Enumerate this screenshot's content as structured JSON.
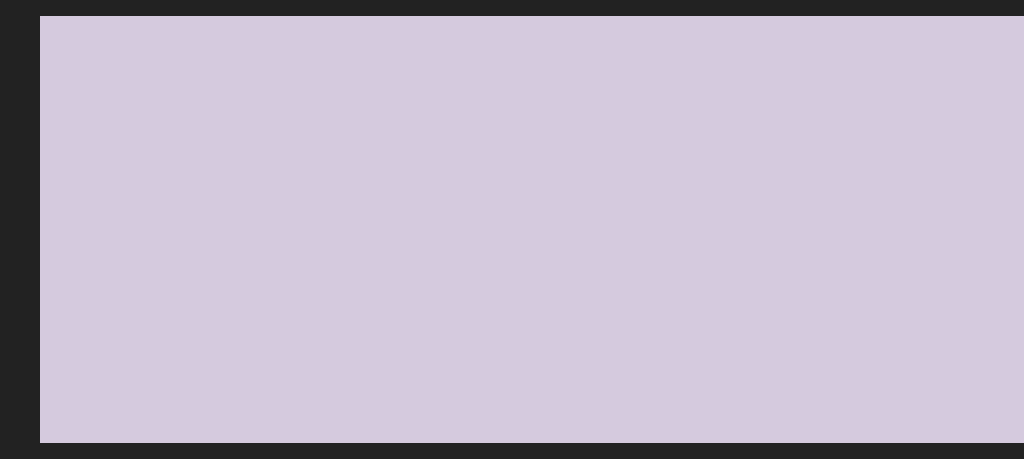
{
  "meta": {
    "description": "Aerial 3D architectural rendering of a gated villa community: two staggered rows of ten white duplex villas with copper hip roofs and dormers, each plot with a turquoise private pool, timber sun deck, loungers, parasols, tan feature walls and palm trees; a tree-lined road runs behind the estate, a curving road bordered by dense woodland runs along the right, stone retaining walls and large trees frame the lower-left foreground",
    "width": 1024,
    "height": 427
  },
  "palette": {
    "canvas": "#d5cade",
    "road": "#cdc2d9",
    "roadLight": "#ded4e0",
    "roadDark": "#b2a2bb",
    "roadShadow": "#6b5a86",
    "curb": "#f1ecf6",
    "centerline": "#fafdff",
    "paleGround": "#d8d0c6",
    "distantTan": "#c4b29e",
    "lawn": "#63a433",
    "lawnLight": "#7fbd45",
    "lawnShade": "#4f8a2c",
    "hedge": "#3f6134",
    "backWall": "#75777f",
    "wallLight": "#a6a3b2",
    "wallDark": "#565869",
    "wallCap": "#cfccd6",
    "stoneDark": "#544f4a",
    "stoneCap": "#9b97a1",
    "stoneTick": "#d3cfd8",
    "shadowPath": "#5a5477",
    "frontFace": "#efe8da",
    "sideFace": "#faf6ec",
    "slab": "#f8f4ea",
    "underEave": "#cdbfae",
    "winDark": "#2f3b41",
    "winTeal": "#5b8a92",
    "wood": "#7b4f2c",
    "roofBase": "#b97c4a",
    "roofStripe": "#935c33",
    "roofRidge": "#ecc196",
    "roofHipEdge": "#e5b98b",
    "fascia": "#f6f1e8",
    "roofShrub": "#4c7c3a",
    "pool": "#2cb3cd",
    "poolDeep": "#1b98b5",
    "poolEdge": "#ece4d2",
    "deck": "#cf9f63",
    "featureWall": "#c9a575",
    "featureWallTop": "#e0c292",
    "slat": "#7e522d",
    "pergola": "#2b3750",
    "parasol": "#f6f4ef",
    "palmTrunk": "#7d5f3e",
    "palmFrond": "#3f7a37",
    "palmFrondLight": "#66a34c",
    "treeBase": "#6b9150",
    "treeHi": "#8fb36c",
    "treeDark": "#49693a",
    "forestFloor": "#4e6a42",
    "forestBase": "#87a06f",
    "forestHi": "#a9bd8c",
    "forestDark": "#5a784c",
    "forestDeep": "#3d5837",
    "bigTreeBase": "#567d40",
    "bigTreeHi": "#7ca75c",
    "bigTreeDark": "#35522b",
    "bigTreeTop": "#95bd74",
    "redRoof": "#a34e37",
    "redRoofDark": "#8f4531",
    "buildingShadow": "#2e4a22"
  },
  "villaGeometry": {
    "basisU": [
      1,
      -0.42
    ],
    "basisV": [
      0.62,
      0.34
    ],
    "W": 150,
    "D": 58,
    "H": 52,
    "rise": 36,
    "overhang": 9,
    "ridgeInset": 40,
    "pool": {
      "back": {
        "a0": 82,
        "a1": 142,
        "b0": 58,
        "b1": 100
      },
      "front": {
        "a0": 82,
        "a1": 138,
        "b0": 116,
        "b1": 168
      }
    }
  },
  "villas": [
    {
      "id": "back-5",
      "x": 512,
      "y": 72,
      "s": 0.57,
      "row": "back",
      "dormers": 2,
      "plotDepth": 150,
      "plotW": 224,
      "palms": [
        [
          192,
          40
        ],
        [
          30,
          124
        ]
      ]
    },
    {
      "id": "back-4",
      "x": 424,
      "y": 106,
      "s": 0.62,
      "row": "back",
      "dormers": 2,
      "plotDepth": 150,
      "plotW": 224,
      "palms": [
        [
          192,
          42
        ],
        [
          32,
          126
        ]
      ]
    },
    {
      "id": "back-3",
      "x": 330,
      "y": 142,
      "s": 0.68,
      "row": "back",
      "dormers": 2,
      "plotDepth": 152,
      "plotW": 224,
      "palms": [
        [
          194,
          40
        ],
        [
          30,
          128
        ]
      ]
    },
    {
      "id": "back-2",
      "x": 232,
      "y": 180,
      "s": 0.74,
      "row": "back",
      "dormers": 2,
      "plotDepth": 154,
      "plotW": 224,
      "palms": [
        [
          192,
          44
        ],
        [
          34,
          128
        ]
      ]
    },
    {
      "id": "back-1",
      "x": 128,
      "y": 222,
      "s": 0.8,
      "row": "back",
      "dormers": 3,
      "plotDepth": 156,
      "plotW": 224,
      "palms": [
        [
          196,
          42
        ],
        [
          36,
          132
        ]
      ]
    },
    {
      "id": "front-5",
      "x": 720,
      "y": 103,
      "s": 0.7,
      "row": "front",
      "dormers": 2,
      "plotDepth": 135,
      "plotW": 190,
      "palms": [
        [
          184,
          128
        ],
        [
          24,
          150
        ]
      ]
    },
    {
      "id": "front-4",
      "x": 616,
      "y": 155,
      "s": 0.78,
      "row": "front",
      "dormers": 2,
      "plotDepth": 150,
      "plotW": 210,
      "palms": [
        [
          200,
          134
        ],
        [
          26,
          154
        ]
      ]
    },
    {
      "id": "front-3",
      "x": 506,
      "y": 210,
      "s": 0.86,
      "row": "front",
      "dormers": 2,
      "plotDepth": 168,
      "plotW": 224,
      "pergola": true,
      "palms": [
        [
          204,
          142
        ],
        [
          26,
          158
        ]
      ]
    },
    {
      "id": "front-2",
      "x": 390,
      "y": 268,
      "s": 0.94,
      "row": "front",
      "dormers": 2,
      "plotDepth": 182,
      "plotW": 224,
      "pergola": true,
      "palms": [
        [
          206,
          146
        ],
        [
          26,
          162
        ]
      ]
    },
    {
      "id": "front-1",
      "x": 268,
      "y": 330,
      "s": 1.02,
      "row": "front",
      "dormers": 3,
      "plotDepth": 195,
      "plotW": 224,
      "palms": [
        [
          208,
          150
        ],
        [
          30,
          168
        ]
      ]
    }
  ],
  "leftRoad": {
    "poly": [
      [
        0,
        118
      ],
      [
        596,
        0
      ],
      [
        700,
        0
      ],
      [
        0,
        196
      ]
    ],
    "junctionArm": [
      [
        205,
        0
      ],
      [
        262,
        0
      ],
      [
        318,
        48
      ],
      [
        252,
        62
      ]
    ],
    "centerline": {
      "from": [
        0,
        158
      ],
      "to": [
        640,
        -6
      ]
    },
    "curbTop": {
      "from": [
        0,
        118
      ],
      "to": [
        596,
        0
      ]
    },
    "curbBottom": {
      "from": [
        0,
        196
      ],
      "to": [
        700,
        0
      ]
    },
    "hedgeBand": [
      [
        0,
        200
      ],
      [
        708,
        0
      ],
      [
        716,
        0
      ],
      [
        0,
        212
      ]
    ],
    "wallBand": [
      [
        0,
        212
      ],
      [
        716,
        0
      ],
      [
        726,
        0
      ],
      [
        0,
        224
      ]
    ]
  },
  "estate": {
    "outline": [
      [
        0,
        224
      ],
      [
        724,
        0
      ],
      [
        893,
        0
      ],
      [
        820,
        210
      ],
      [
        695,
        380
      ],
      [
        612,
        427
      ],
      [
        190,
        427
      ],
      [
        0,
        310
      ]
    ],
    "mottles": [
      [
        [
          60,
          250
        ],
        [
          240,
          178
        ],
        [
          300,
          200
        ],
        [
          120,
          278
        ]
      ],
      [
        [
          340,
          120
        ],
        [
          520,
          50
        ],
        [
          580,
          70
        ],
        [
          400,
          146
        ]
      ],
      [
        [
          480,
          260
        ],
        [
          640,
          190
        ],
        [
          700,
          214
        ],
        [
          540,
          290
        ]
      ]
    ]
  },
  "rightRoad": {
    "leftEdge": [
      [
        893,
        0
      ],
      [
        865,
        120
      ],
      [
        820,
        210
      ],
      [
        758,
        300
      ],
      [
        690,
        380
      ],
      [
        628,
        427
      ]
    ],
    "rightEdge": [
      [
        925,
        0
      ],
      [
        900,
        115
      ],
      [
        874,
        205
      ],
      [
        832,
        300
      ],
      [
        788,
        380
      ],
      [
        790,
        427
      ]
    ],
    "wallInner": [
      [
        880,
        0
      ],
      [
        852,
        115
      ],
      [
        807,
        205
      ],
      [
        745,
        295
      ],
      [
        677,
        375
      ],
      [
        615,
        427
      ]
    ],
    "wallDarkFrom": 3,
    "shadowSpots": [
      [
        905,
        60
      ],
      [
        885,
        130
      ],
      [
        850,
        200
      ],
      [
        815,
        265
      ],
      [
        778,
        330
      ],
      [
        735,
        390
      ]
    ]
  },
  "terraces": {
    "lawnStrip": [
      [
        150,
        415
      ],
      [
        330,
        334
      ],
      [
        352,
        352
      ],
      [
        165,
        427
      ]
    ],
    "shadowPath": [
      [
        128,
        427
      ],
      [
        208,
        427
      ],
      [
        318,
        335
      ],
      [
        296,
        325
      ],
      [
        150,
        414
      ]
    ],
    "walkway": [
      [
        193,
        420
      ],
      [
        378,
        345
      ],
      [
        382,
        356
      ],
      [
        197,
        431
      ]
    ],
    "wallFace": [
      [
        197,
        431
      ],
      [
        382,
        356
      ],
      [
        384,
        368
      ],
      [
        199,
        443
      ]
    ],
    "tickCount": 15
  },
  "redRoofs": [
    [
      [
        0,
        128
      ],
      [
        26,
        122
      ],
      [
        34,
        150
      ],
      [
        0,
        160
      ]
    ],
    [
      [
        0,
        236
      ],
      [
        30,
        228
      ],
      [
        40,
        256
      ],
      [
        0,
        266
      ]
    ]
  ],
  "paleCorners": {
    "topLeft": [
      [
        0,
        0
      ],
      [
        200,
        0
      ],
      [
        160,
        40
      ],
      [
        0,
        70
      ]
    ],
    "distant": [
      [
        60,
        0
      ],
      [
        230,
        0
      ],
      [
        225,
        16
      ],
      [
        70,
        22
      ]
    ],
    "gap": [
      [
        290,
        0
      ],
      [
        560,
        0
      ],
      [
        540,
        22
      ],
      [
        300,
        26
      ]
    ]
  },
  "treeBands": [
    {
      "name": "roadside-trees-front",
      "from": [
        -25,
        135
      ],
      "to": [
        560,
        -15
      ],
      "count": 14,
      "rMin": 20,
      "rMax": 30,
      "jitter": 8,
      "seed": 11,
      "shadow": true
    },
    {
      "name": "roadside-trees-back",
      "from": [
        -20,
        80
      ],
      "to": [
        300,
        -22
      ],
      "count": 8,
      "rMin": 16,
      "rMax": 24,
      "jitter": 7,
      "seed": 23,
      "shadow": false
    },
    {
      "name": "top-edge-trees",
      "from": [
        556,
        4
      ],
      "to": [
        892,
        -10
      ],
      "count": 10,
      "rMin": 13,
      "rMax": 20,
      "jitter": 6,
      "seed": 31,
      "shadow": false
    }
  ],
  "forest": {
    "poly": [
      [
        915,
        0
      ],
      [
        1024,
        0
      ],
      [
        1024,
        427
      ],
      [
        648,
        427
      ],
      [
        700,
        390
      ],
      [
        770,
        300
      ],
      [
        820,
        220
      ],
      [
        862,
        120
      ],
      [
        880,
        40
      ]
    ],
    "count": 55,
    "rMin": 20,
    "rMax": 40,
    "seed": 7
  },
  "bigTrees": [
    {
      "x": -6,
      "y": 300,
      "r": 40
    },
    {
      "x": 48,
      "y": 318,
      "r": 58
    },
    {
      "x": 142,
      "y": 352,
      "r": 62
    },
    {
      "x": 232,
      "y": 398,
      "r": 54
    },
    {
      "x": 16,
      "y": 398,
      "r": 48
    },
    {
      "x": 88,
      "y": 420,
      "r": 42
    }
  ],
  "extraPalms": [
    [
      800,
      120
    ],
    [
      828,
      152
    ],
    [
      795,
      205
    ],
    [
      770,
      258
    ],
    [
      846,
      96
    ],
    [
      748,
      300
    ],
    [
      700,
      360
    ]
  ]
}
